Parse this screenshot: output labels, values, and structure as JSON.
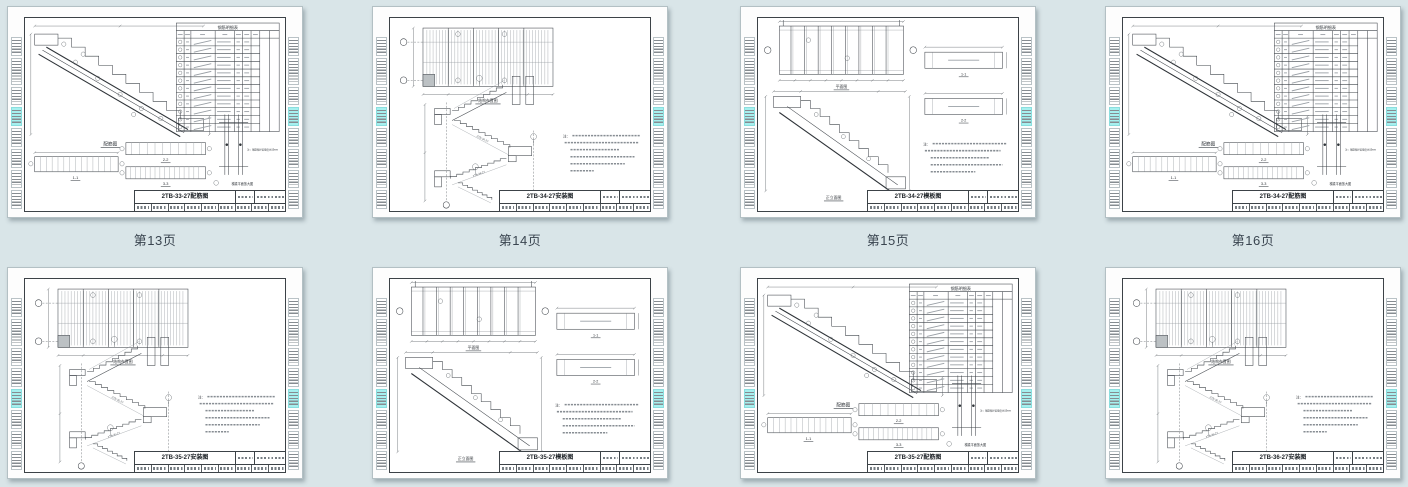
{
  "canvas": {
    "background": "#d9e5e8",
    "highlight_color": "#a6f0ef",
    "line_color": "#3f444a",
    "page_label_color": "#3a4550"
  },
  "strings": {
    "rebar_fig": "配筋图",
    "plan_fig": "平面图",
    "elev_fig": "正立面图",
    "layout_fig": "结构布置图",
    "s11": "1-1",
    "s22": "2-2",
    "s33": "3-3",
    "table_title": "钢筋明细表",
    "detail_label": "梯梁平面放大图",
    "rebar_note": "注：钢筋保护层厚度为15mm",
    "notes_prefix": "注："
  },
  "pages": [
    {
      "title": "2TB-33-27配筋图",
      "variant": "rebar",
      "code": "2TB-33-27",
      "page_label": "第13页",
      "highlight_index": 3
    },
    {
      "title": "2TB-34-27安装图",
      "variant": "install",
      "code": "2TB-34-27",
      "page_label": "第14页",
      "highlight_index": 3
    },
    {
      "title": "2TB-34-27模板图",
      "variant": "formwork",
      "code": "2TB-34-27",
      "page_label": "第15页",
      "highlight_index": 3
    },
    {
      "title": "2TB-34-27配筋图",
      "variant": "rebar",
      "code": "2TB-34-27",
      "page_label": "第16页",
      "highlight_index": 3
    },
    {
      "title": "2TB-35-27安装图",
      "variant": "install",
      "code": "2TB-35-27",
      "highlight_index": 4
    },
    {
      "title": "2TB-35-27模板图",
      "variant": "formwork",
      "code": "2TB-35-27",
      "highlight_index": 4
    },
    {
      "title": "2TB-35-27配筋图",
      "variant": "rebar",
      "code": "2TB-35-27",
      "highlight_index": 4
    },
    {
      "title": "2TB-36-27安装图",
      "variant": "install",
      "code": "2TB-36-27",
      "highlight_index": 4
    }
  ]
}
